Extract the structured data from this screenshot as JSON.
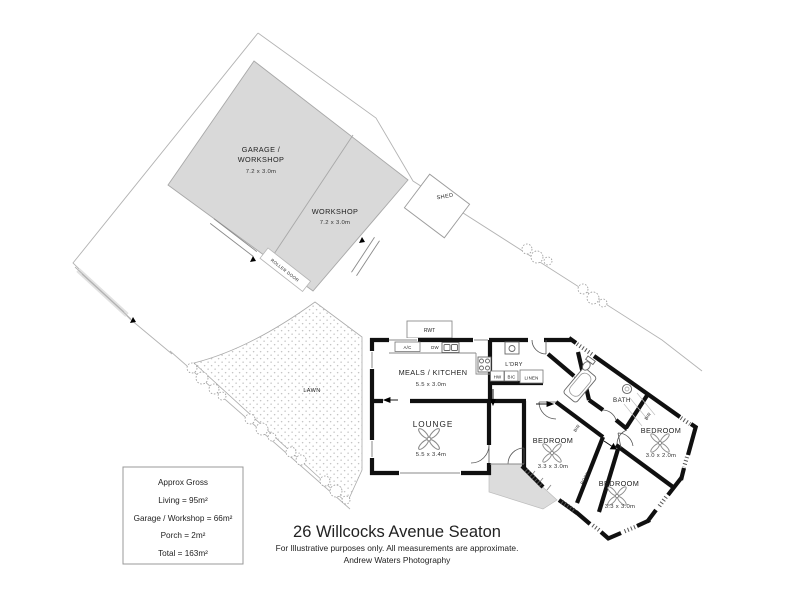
{
  "plan": {
    "outbuildings": {
      "garage": {
        "line1": "GARAGE /",
        "line2": "WORKSHOP",
        "dims": "7.2 x 3.0m"
      },
      "workshop": {
        "name": "WORKSHOP",
        "dims": "7.2 x 3.0m"
      },
      "roller_door": "ROLLER DOOR",
      "shed": "SHED",
      "rwt": "RWT"
    },
    "site": {
      "lawn": "LAWN"
    },
    "rooms": {
      "meals_kitchen": {
        "name": "MEALS / KITCHEN",
        "dims": "5.5 x 3.0m"
      },
      "lounge": {
        "name": "LOUNGE",
        "dims": "5.5 x 3.4m"
      },
      "laundry": {
        "name": "L'DRY"
      },
      "bath": {
        "name": "BATH"
      },
      "bedroom1": {
        "name": "BEDROOM",
        "dims": "3.3 x 3.0m"
      },
      "bedroom2": {
        "name": "BEDROOM",
        "dims": "3.0 x 2.0m"
      },
      "bedroom3": {
        "name": "BEDROOM",
        "dims": "3.3 x 3.0m"
      }
    },
    "labels": {
      "ac": "A/C",
      "dw": "DW",
      "hw": "HW",
      "bic": "BIC",
      "linen": "LINEN",
      "bir": "BIR",
      "robe": "ROBE"
    }
  },
  "legend": {
    "title": "Approx Gross",
    "lines": [
      "Living = 95m²",
      "Garage / Workshop = 66m²",
      "Porch = 2m²",
      "Total = 163m²"
    ]
  },
  "footer": {
    "title": "26 Willcocks Avenue Seaton",
    "disclaimer": "For Illustrative purposes only.  All measurements are approximate.",
    "credit": "Andrew Waters Photography"
  }
}
